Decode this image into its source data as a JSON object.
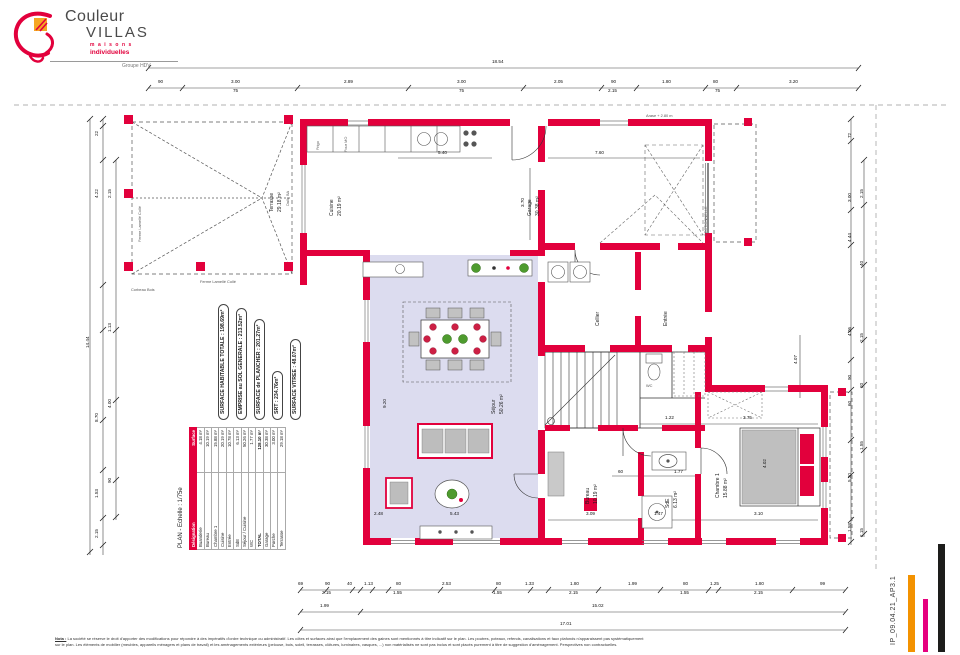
{
  "logo": {
    "brand_line1": "Couleur",
    "brand_line2": "VILLAS",
    "sub1": "maisons",
    "sub2": "individuelles",
    "group": "Groupe HDV"
  },
  "colors": {
    "wall": "#e2003c",
    "sejour": "#dcdcef",
    "orange": "#f39200",
    "pink": "#e6007e",
    "black": "#1d1d1b"
  },
  "surfaces": [
    "SURFACE HABITABLE TOTALE : 198.69m²",
    "EMPRISE au SOL GENERALE : 213.52m²",
    "SURFACE de PLANCHER : 201.27m²",
    "SRT : 234.76m²",
    "SURFACE VITREE : 48.07m²"
  ],
  "plan_table": {
    "title": "PLAN - Echelle : 1/75e",
    "header": {
      "name": "Désignation",
      "area": "Surface"
    },
    "rows": [
      {
        "name": "Buanderie",
        "area": "4.18 m²"
      },
      {
        "name": "Bureau",
        "area": "10.19 m²"
      },
      {
        "name": "Chambre 1",
        "area": "15.88 m²"
      },
      {
        "name": "Cuisine",
        "area": "20.19 m²"
      },
      {
        "name": "Entrée",
        "area": "10.78 m²"
      },
      {
        "name": "SdE",
        "area": "6.13 m²"
      },
      {
        "name": "Séjour / Cuisine",
        "area": "50.26 m²"
      },
      {
        "name": "WC",
        "area": "1.77 m²"
      }
    ],
    "total": {
      "name": "TOTAL",
      "area": "128.10 m²"
    },
    "annex": [
      {
        "name": "Garage",
        "area": "30.38 m²"
      },
      {
        "name": "Porche",
        "area": "3.00 m²"
      },
      {
        "name": "Terrasse",
        "area": "29.18 m²"
      }
    ]
  },
  "annotations": [
    {
      "t": "Terrasse",
      "x": 270,
      "y": 212,
      "r": 1
    },
    {
      "t": "29.18 m²",
      "x": 278,
      "y": 212,
      "r": 1
    },
    {
      "t": "Dalle BA",
      "x": 286,
      "y": 206,
      "r": 1,
      "s": 1
    },
    {
      "t": "Ferme Lamellé Collé",
      "x": 138,
      "y": 242,
      "r": 1,
      "s": 1
    },
    {
      "t": "Ferme Lamellé Collé",
      "x": 200,
      "y": 280,
      "s": 1
    },
    {
      "t": "Corbeau Bois",
      "x": 131,
      "y": 288,
      "s": 1
    },
    {
      "t": "Cuisine",
      "x": 330,
      "y": 216,
      "r": 1
    },
    {
      "t": "20.19 m²",
      "x": 338,
      "y": 216,
      "r": 1
    },
    {
      "t": "Frigo",
      "x": 316,
      "y": 150,
      "r": 1,
      "s": 1
    },
    {
      "t": "Four MO",
      "x": 344,
      "y": 152,
      "r": 1,
      "s": 1
    },
    {
      "t": "Garage",
      "x": 528,
      "y": 216,
      "r": 1
    },
    {
      "t": "30.38 m²",
      "x": 536,
      "y": 216,
      "r": 1
    },
    {
      "t": "SECTIONNELLE",
      "x": 704,
      "y": 236,
      "r": 1,
      "s": 1
    },
    {
      "t": "Arase + 2.80 m",
      "x": 646,
      "y": 114,
      "s": 1
    },
    {
      "t": "Séjour",
      "x": 492,
      "y": 414,
      "r": 1
    },
    {
      "t": "50.26 m²",
      "x": 500,
      "y": 414,
      "r": 1
    },
    {
      "t": "Cellier",
      "x": 596,
      "y": 326,
      "r": 1
    },
    {
      "t": "Entrée",
      "x": 664,
      "y": 326,
      "r": 1
    },
    {
      "t": "WC",
      "x": 646,
      "y": 384,
      "s": 1
    },
    {
      "t": "Bureau",
      "x": 586,
      "y": 504,
      "r": 1
    },
    {
      "t": "10.19 m²",
      "x": 594,
      "y": 504,
      "r": 1
    },
    {
      "t": "SdE",
      "x": 666,
      "y": 508,
      "r": 1
    },
    {
      "t": "6.13 m²",
      "x": 674,
      "y": 508,
      "r": 1
    },
    {
      "t": "Chambre 1",
      "x": 716,
      "y": 498,
      "r": 1
    },
    {
      "t": "15.88 m²",
      "x": 724,
      "y": 498,
      "r": 1
    }
  ],
  "dims": {
    "top": [
      {
        "t": "18.54",
        "x": 492,
        "y": 60
      },
      {
        "t": "90",
        "x": 158,
        "y": 80
      },
      {
        "t": "3.00",
        "x": 231,
        "y": 80
      },
      {
        "t": "75",
        "x": 233,
        "y": 89
      },
      {
        "t": "2.89",
        "x": 344,
        "y": 80
      },
      {
        "t": "3.00",
        "x": 457,
        "y": 80
      },
      {
        "t": "75",
        "x": 459,
        "y": 89
      },
      {
        "t": "2.05",
        "x": 554,
        "y": 80
      },
      {
        "t": "90",
        "x": 611,
        "y": 80
      },
      {
        "t": "2.15",
        "x": 608,
        "y": 89
      },
      {
        "t": "1.80",
        "x": 662,
        "y": 80
      },
      {
        "t": "80",
        "x": 713,
        "y": 80
      },
      {
        "t": "75",
        "x": 715,
        "y": 89
      },
      {
        "t": "3.20",
        "x": 789,
        "y": 80
      }
    ],
    "bottom": [
      {
        "t": "69",
        "x": 298,
        "y": 582
      },
      {
        "t": "90",
        "x": 325,
        "y": 582
      },
      {
        "t": "2.15",
        "x": 322,
        "y": 591
      },
      {
        "t": "40",
        "x": 347,
        "y": 582
      },
      {
        "t": "1.13",
        "x": 364,
        "y": 582
      },
      {
        "t": "80",
        "x": 396,
        "y": 582
      },
      {
        "t": "1.55",
        "x": 393,
        "y": 591
      },
      {
        "t": "2.53",
        "x": 442,
        "y": 582
      },
      {
        "t": "80",
        "x": 496,
        "y": 582
      },
      {
        "t": "1.55",
        "x": 493,
        "y": 591
      },
      {
        "t": "1.33",
        "x": 525,
        "y": 582
      },
      {
        "t": "1.80",
        "x": 570,
        "y": 582
      },
      {
        "t": "2.15",
        "x": 569,
        "y": 591
      },
      {
        "t": "1.99",
        "x": 628,
        "y": 582
      },
      {
        "t": "80",
        "x": 683,
        "y": 582
      },
      {
        "t": "1.55",
        "x": 680,
        "y": 591
      },
      {
        "t": "1.25",
        "x": 710,
        "y": 582
      },
      {
        "t": "1.80",
        "x": 755,
        "y": 582
      },
      {
        "t": "2.15",
        "x": 754,
        "y": 591
      },
      {
        "t": "99",
        "x": 820,
        "y": 582
      },
      {
        "t": "1.99",
        "x": 320,
        "y": 604
      },
      {
        "t": "15.02",
        "x": 592,
        "y": 604
      },
      {
        "t": "17.01",
        "x": 560,
        "y": 622
      }
    ],
    "left": [
      {
        "t": "22",
        "x": 95,
        "y": 136,
        "r": 1
      },
      {
        "t": "4.22",
        "x": 95,
        "y": 198,
        "r": 1
      },
      {
        "t": "2.15",
        "x": 108,
        "y": 198,
        "r": 1
      },
      {
        "t": "14.44",
        "x": 86,
        "y": 348,
        "r": 1
      },
      {
        "t": "1.13",
        "x": 108,
        "y": 332,
        "r": 1
      },
      {
        "t": "8.70",
        "x": 95,
        "y": 422,
        "r": 1
      },
      {
        "t": "4.00",
        "x": 108,
        "y": 408,
        "r": 1
      },
      {
        "t": "1.53",
        "x": 95,
        "y": 498,
        "r": 1
      },
      {
        "t": "90",
        "x": 108,
        "y": 483,
        "r": 1
      },
      {
        "t": "2.15",
        "x": 95,
        "y": 538,
        "r": 1
      }
    ],
    "right": [
      {
        "t": "72",
        "x": 848,
        "y": 138,
        "r": 1
      },
      {
        "t": "2.15",
        "x": 860,
        "y": 198,
        "r": 1
      },
      {
        "t": "3.00",
        "x": 848,
        "y": 202,
        "r": 1
      },
      {
        "t": "4.44",
        "x": 848,
        "y": 242,
        "r": 1
      },
      {
        "t": "40",
        "x": 860,
        "y": 266,
        "r": 1
      },
      {
        "t": "4.06",
        "x": 848,
        "y": 336,
        "r": 1
      },
      {
        "t": "2.15",
        "x": 860,
        "y": 342,
        "r": 1
      },
      {
        "t": "90",
        "x": 848,
        "y": 380,
        "r": 1
      },
      {
        "t": "20",
        "x": 860,
        "y": 388,
        "r": 1
      },
      {
        "t": "60",
        "x": 848,
        "y": 406,
        "r": 1
      },
      {
        "t": "1.55",
        "x": 860,
        "y": 450,
        "r": 1
      },
      {
        "t": "5.30",
        "x": 848,
        "y": 482,
        "r": 1
      },
      {
        "t": "1.58",
        "x": 848,
        "y": 532,
        "r": 1
      },
      {
        "t": "2.15",
        "x": 860,
        "y": 537,
        "r": 1
      }
    ],
    "inner": [
      {
        "t": "5.40",
        "x": 438,
        "y": 151
      },
      {
        "t": "7.60",
        "x": 595,
        "y": 151
      },
      {
        "t": "3.70",
        "x": 521,
        "y": 207,
        "r": 1
      },
      {
        "t": "9.20",
        "x": 383,
        "y": 408,
        "r": 1
      },
      {
        "t": "2.48",
        "x": 374,
        "y": 512
      },
      {
        "t": "5.43",
        "x": 450,
        "y": 512
      },
      {
        "t": "3.09",
        "x": 586,
        "y": 512
      },
      {
        "t": "1.47",
        "x": 654,
        "y": 512
      },
      {
        "t": "3.10",
        "x": 754,
        "y": 512
      },
      {
        "t": "3.75",
        "x": 743,
        "y": 416
      },
      {
        "t": "1.22",
        "x": 665,
        "y": 416
      },
      {
        "t": "4.02",
        "x": 763,
        "y": 468,
        "r": 1
      },
      {
        "t": "1.77",
        "x": 674,
        "y": 470
      },
      {
        "t": "60",
        "x": 618,
        "y": 470
      },
      {
        "t": "4.07",
        "x": 794,
        "y": 364,
        "r": 1
      }
    ]
  },
  "footer": {
    "label": "Nota :",
    "line1": "La société se réserve le droit d'apporter des modifications pour répondre à des impératifs d'ordre technique ou administratif. Les côtes et surfaces ainsi que l'emplacement des gaines sont mentionnés à titre indicatif sur le plan. Les poutres, poteaux, refends, canalisations et faux plafonds n'apparaissent pas systématiquement",
    "line2": "sur le plan. Les éléments de mobilier (meubles, appareils ménagers et plans de travail) et les aménagements extérieurs (pelouse, bois, soleil, terrasses, clôtures, luminaires, vasques, ...) non matérialisés ne sont pas inclus et sont placés purement à titre de suggestion d'aménagement. Perspectives non contractuelles."
  },
  "ref_code": "IP_09.04.21_AP3.1"
}
